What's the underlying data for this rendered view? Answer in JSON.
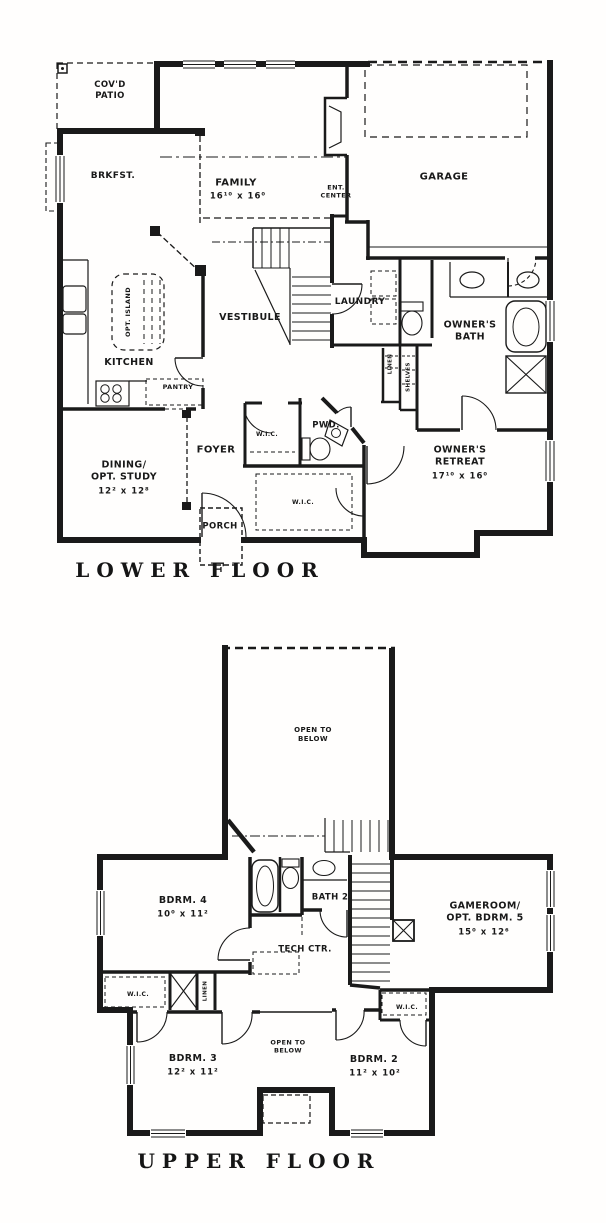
{
  "page": {
    "background": "#ffffff",
    "ink": "#1a1a1a"
  },
  "lower_floor": {
    "title": "LOWER FLOOR",
    "rooms": {
      "covd_patio": {
        "name": "COV'D\nPATIO"
      },
      "brkfst": {
        "name": "BRKFST."
      },
      "family": {
        "name": "FAMILY",
        "dims": "16¹⁰ x 16⁰"
      },
      "ent_center": {
        "name": "ENT.\nCENTER"
      },
      "garage": {
        "name": "GARAGE"
      },
      "opt_island": {
        "name": "OPT. ISLAND"
      },
      "kitchen": {
        "name": "KITCHEN"
      },
      "pantry": {
        "name": "PANTRY"
      },
      "vestibule": {
        "name": "VESTIBULE"
      },
      "laundry": {
        "name": "LAUNDRY"
      },
      "linen": {
        "name": "LINEN"
      },
      "shelves": {
        "name": "SHELVES"
      },
      "owners_bath": {
        "name": "OWNER'S\nBATH"
      },
      "wic_hall": {
        "name": "W.I.C."
      },
      "pwd": {
        "name": "PWD."
      },
      "foyer": {
        "name": "FOYER"
      },
      "dining": {
        "name": "DINING/\nOPT. STUDY",
        "dims": "12² x 12⁸"
      },
      "wic_owner": {
        "name": "W.I.C."
      },
      "owners_retreat": {
        "name": "OWNER'S\nRETREAT",
        "dims": "17¹⁰ x 16⁰"
      },
      "porch": {
        "name": "PORCH"
      }
    }
  },
  "upper_floor": {
    "title": "UPPER FLOOR",
    "rooms": {
      "open_to_below": {
        "name": "OPEN TO\nBELOW"
      },
      "bdrm4": {
        "name": "BDRM. 4",
        "dims": "10⁰ x 11²"
      },
      "bath2": {
        "name": "BATH 2"
      },
      "tech_ctr": {
        "name": "TECH CTR."
      },
      "gameroom": {
        "name": "GAMEROOM/\nOPT. BDRM. 5",
        "dims": "15⁰ x 12⁶"
      },
      "wic_left": {
        "name": "W.I.C."
      },
      "linen": {
        "name": "LINEN"
      },
      "wic_right": {
        "name": "W.I.C."
      },
      "bdrm3": {
        "name": "BDRM. 3",
        "dims": "12² x 11²"
      },
      "open_to_below_small": {
        "name": "OPEN TO\nBELOW"
      },
      "bdrm2": {
        "name": "BDRM. 2",
        "dims": "11² x 10²"
      }
    }
  }
}
